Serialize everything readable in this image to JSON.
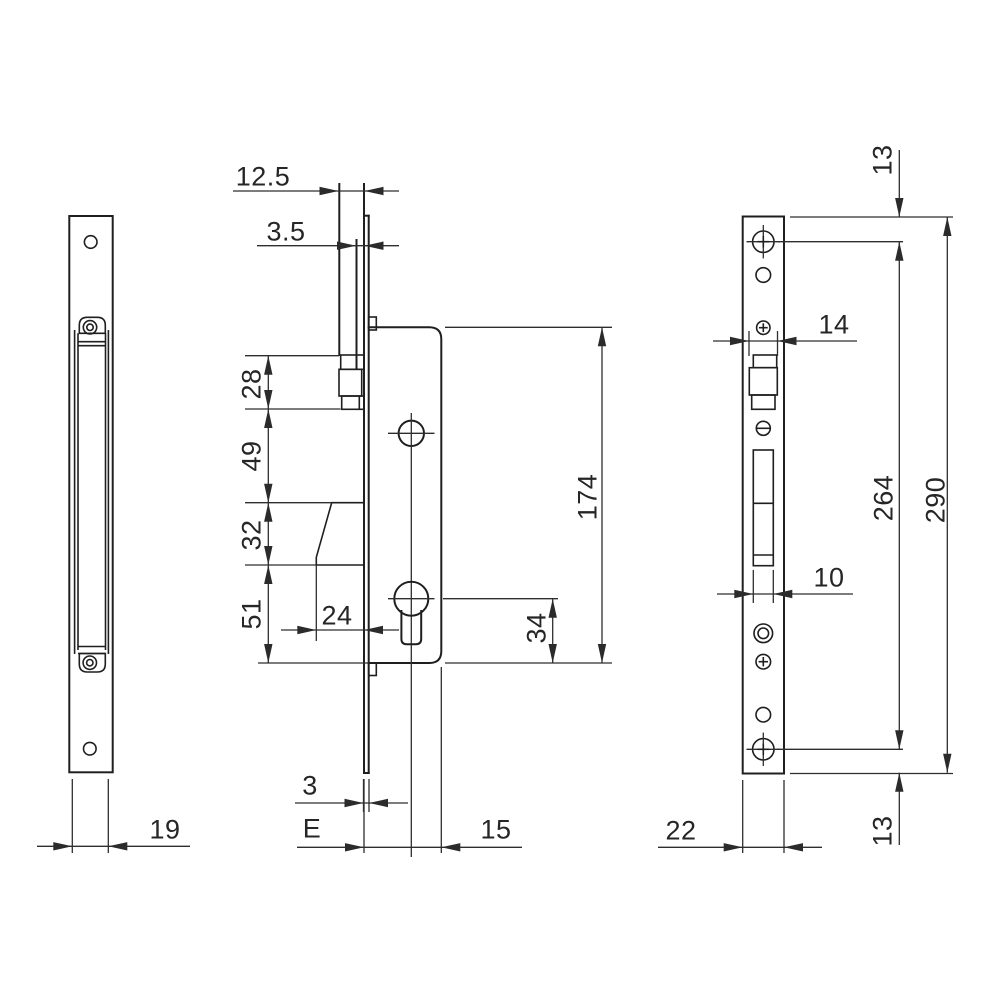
{
  "drawing": {
    "type": "technical-dimension-drawing",
    "subject": "mortise lock with faceplate, latch and euro cylinder",
    "background_color": "#ffffff",
    "object_line_color": "#1f1f1f",
    "dimension_line_color": "#2e2e2e",
    "views": {
      "side_view": {
        "dims": {
          "case_depth": "19"
        }
      },
      "front_view": {
        "dims": {
          "rod_width": "12.5",
          "rod_wall_thickness": "3.5",
          "latch_height": "28",
          "latch_to_hub": "49",
          "hub_to_cylinder": "32",
          "cylinder_to_case_bottom_left": "51",
          "nose_to_plate": "24",
          "case_height": "174",
          "cylinder_axis_to_case_bottom": "34",
          "plate_thickness": "3",
          "backset": "E",
          "axis_to_case_edge": "15"
        }
      },
      "faceplate_view": {
        "dims": {
          "latch_width": "14",
          "bolt_slot_width": "10",
          "plate_width": "22",
          "top_edge_to_screw": "13",
          "screw_to_screw": "264",
          "plate_height": "290",
          "screw_to_bottom_edge": "13"
        }
      }
    }
  }
}
